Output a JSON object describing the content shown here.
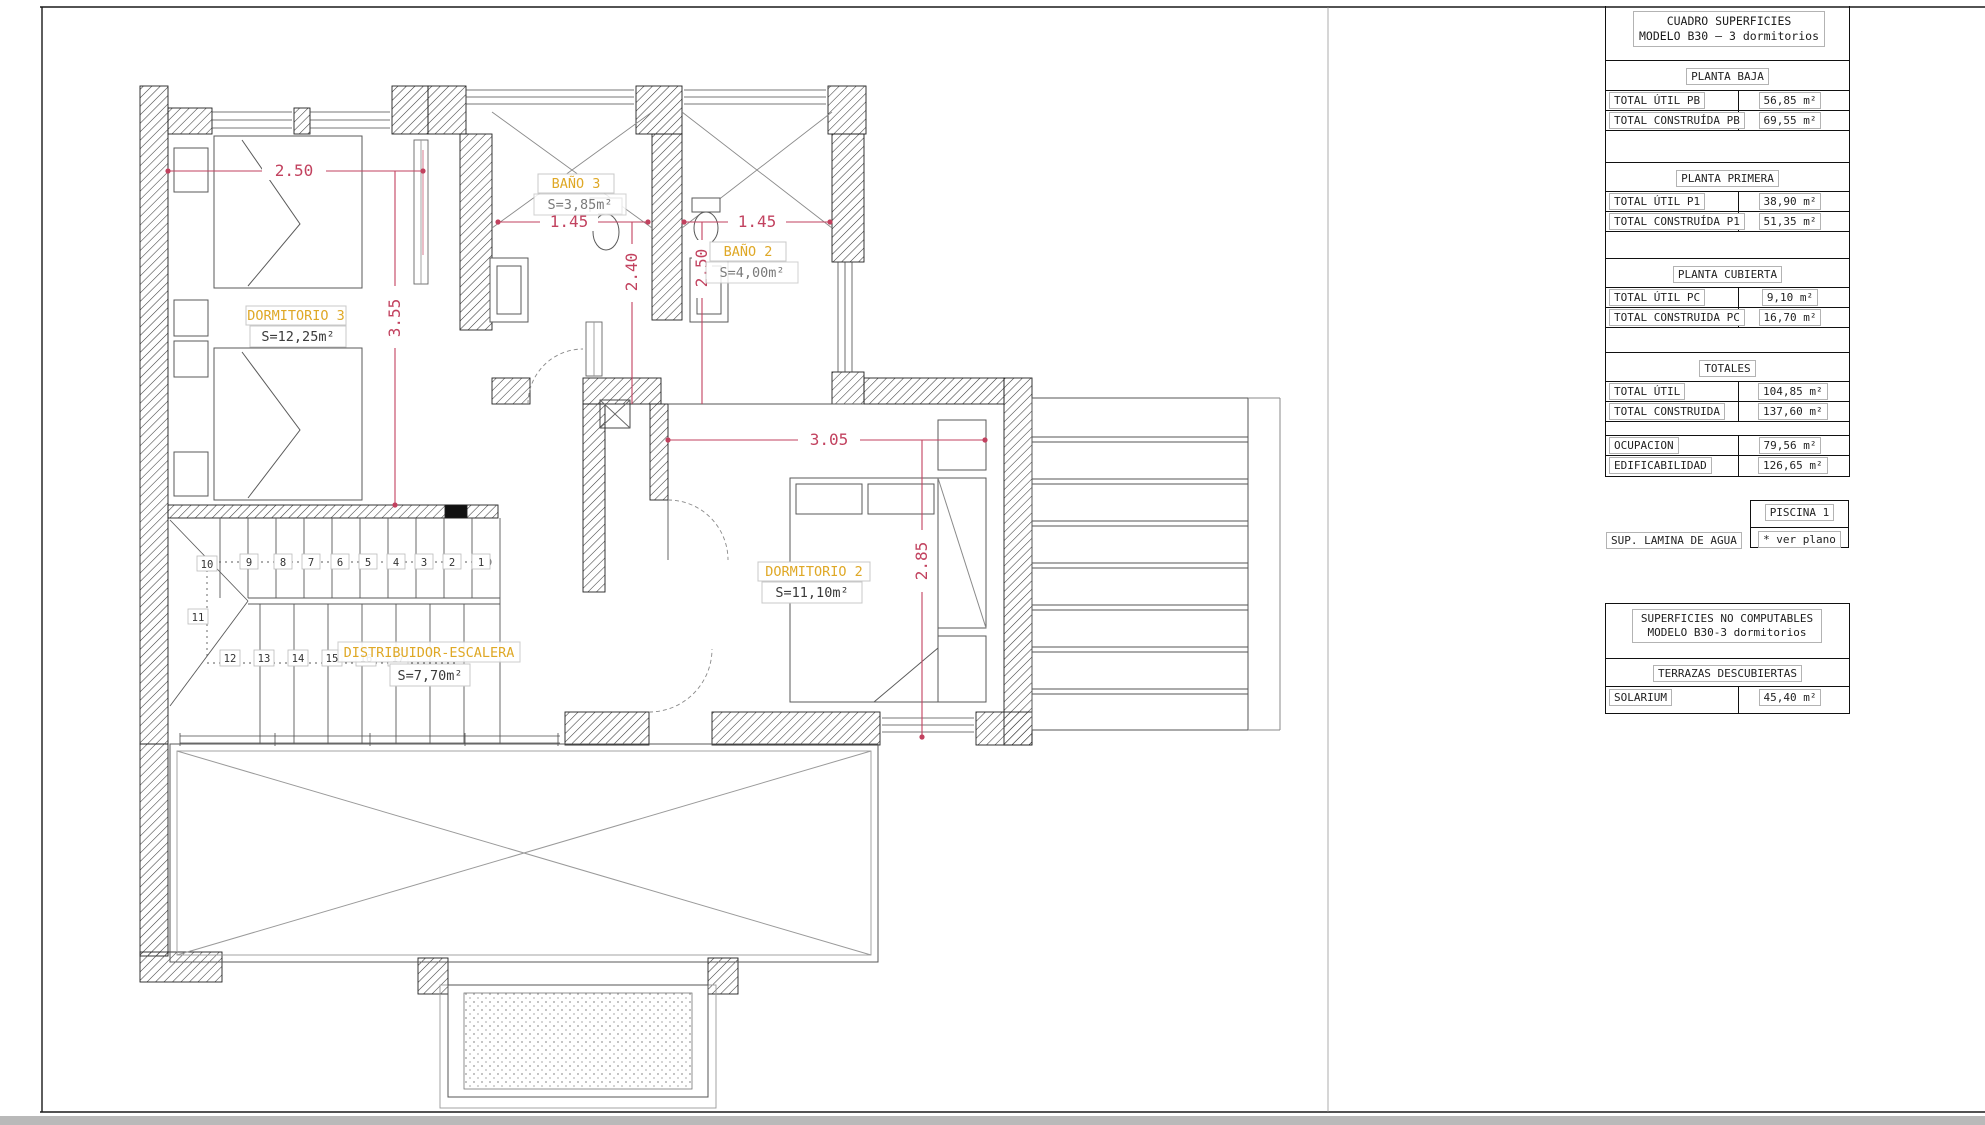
{
  "plan": {
    "rooms": [
      {
        "name": "DORMITORIO 3",
        "area": "S=12,25m²"
      },
      {
        "name": "BAÑO 3",
        "area": "S=3,85m²"
      },
      {
        "name": "BAÑO 2",
        "area": "S=4,00m²"
      },
      {
        "name": "DORMITORIO 2",
        "area": "S=11,10m²"
      },
      {
        "name": "DISTRIBUIDOR-ESCALERA",
        "area": "S=7,70m²"
      }
    ],
    "dims": {
      "top_width": "2.50",
      "bath3_width": "1.45",
      "bath2_width": "1.45",
      "dorm3_depth": "3.55",
      "bath3_depth": "2.40",
      "bath2_depth": "2.50",
      "dorm2_width": "3.05",
      "dorm2_depth": "2.85"
    },
    "stairs": [
      "1",
      "2",
      "3",
      "4",
      "5",
      "6",
      "7",
      "8",
      "9",
      "10",
      "11",
      "12",
      "13",
      "14",
      "15",
      "16",
      "17"
    ],
    "colors": {
      "dimension": "#c2425f",
      "room_label": "#dfa826"
    }
  },
  "surfaces_table": {
    "title_line1": "CUADRO SUPERFICIES",
    "title_line2": "MODELO B30 – 3 dormitorios",
    "sections": [
      {
        "title": "PLANTA BAJA",
        "rows": [
          {
            "label": "TOTAL ÚTIL PB",
            "value": "56,85 m²"
          },
          {
            "label": "TOTAL CONSTRUÍDA PB",
            "value": "69,55 m²"
          }
        ]
      },
      {
        "title": "PLANTA PRIMERA",
        "rows": [
          {
            "label": "TOTAL ÚTIL P1",
            "value": "38,90 m²"
          },
          {
            "label": "TOTAL CONSTRUÍDA P1",
            "value": "51,35 m²"
          }
        ]
      },
      {
        "title": "PLANTA CUBIERTA",
        "rows": [
          {
            "label": "TOTAL ÚTIL PC",
            "value": "9,10 m²"
          },
          {
            "label": "TOTAL CONSTRUIDA PC",
            "value": "16,70 m²"
          }
        ]
      },
      {
        "title": "TOTALES",
        "rows": [
          {
            "label": "TOTAL ÚTIL",
            "value": "104,85 m²"
          },
          {
            "label": "TOTAL CONSTRUIDA",
            "value": "137,60 m²"
          }
        ]
      }
    ],
    "summary": [
      {
        "label": "OCUPACION",
        "value": "79,56 m²"
      },
      {
        "label": "EDIFICABILIDAD",
        "value": "126,65 m²"
      }
    ],
    "piscina": {
      "title": "PISCINA 1",
      "label": "SUP. LAMINA DE AGUA",
      "value": "* ver plano"
    },
    "no_computables": {
      "title_line1": "SUPERFICIES NO COMPUTABLES",
      "title_line2": "MODELO B30-3 dormitorios",
      "subtitle": "TERRAZAS DESCUBIERTAS",
      "rows": [
        {
          "label": "SOLARIUM",
          "value": "45,40 m²"
        }
      ]
    }
  }
}
